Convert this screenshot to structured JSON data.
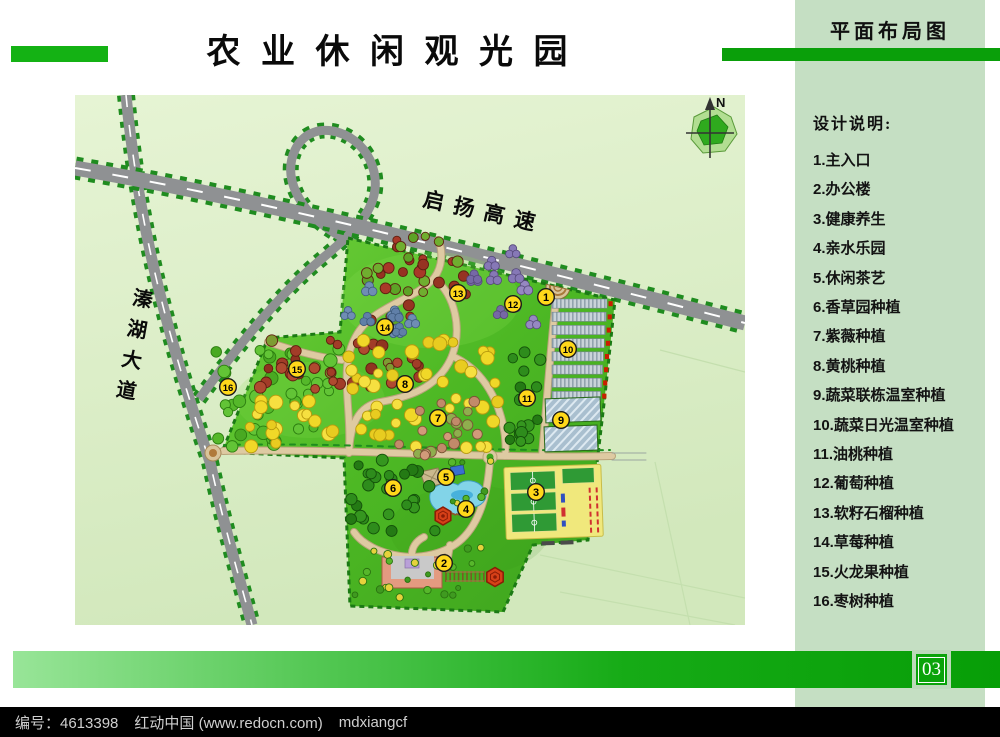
{
  "header": {
    "title": "农 业 休 闲 观 光 园",
    "subtitle": "平面布局图"
  },
  "sidebar": {
    "heading": "设计说明:",
    "items": [
      {
        "num": "1",
        "label": "主入口"
      },
      {
        "num": "2",
        "label": "办公楼"
      },
      {
        "num": "3",
        "label": "健康养生"
      },
      {
        "num": "4",
        "label": "亲水乐园"
      },
      {
        "num": "5",
        "label": "休闲茶艺"
      },
      {
        "num": "6",
        "label": "香草园种植"
      },
      {
        "num": "7",
        "label": "紫薇种植"
      },
      {
        "num": "8",
        "label": "黄桃种植"
      },
      {
        "num": "9",
        "label": "蔬菜联栋温室种植"
      },
      {
        "num": "10",
        "label": "蔬菜日光温室种植"
      },
      {
        "num": "11",
        "label": "油桃种植"
      },
      {
        "num": "12",
        "label": "葡萄种植"
      },
      {
        "num": "13",
        "label": "软籽石榴种植"
      },
      {
        "num": "14",
        "label": "草莓种植"
      },
      {
        "num": "15",
        "label": "火龙果种植"
      },
      {
        "num": "16",
        "label": "枣树种植"
      }
    ]
  },
  "map": {
    "highway_label": "启扬高速",
    "avenue_label": "溱湖大道",
    "north_label": "N"
  },
  "footer": {
    "page_number": "03",
    "id": "编号：4613398",
    "site": "红动中国 (www.redocn.com)",
    "author": "mdxiangcf"
  },
  "colors": {
    "accent_green": "#14b214",
    "dark_green_bar": "#0a9f0a",
    "sidebar_bg": "#c5dfc3",
    "park_green": "#4db824",
    "marker_yellow": "#ffd81a",
    "road_gray": "#8f9193",
    "footer_black": "#000000"
  }
}
